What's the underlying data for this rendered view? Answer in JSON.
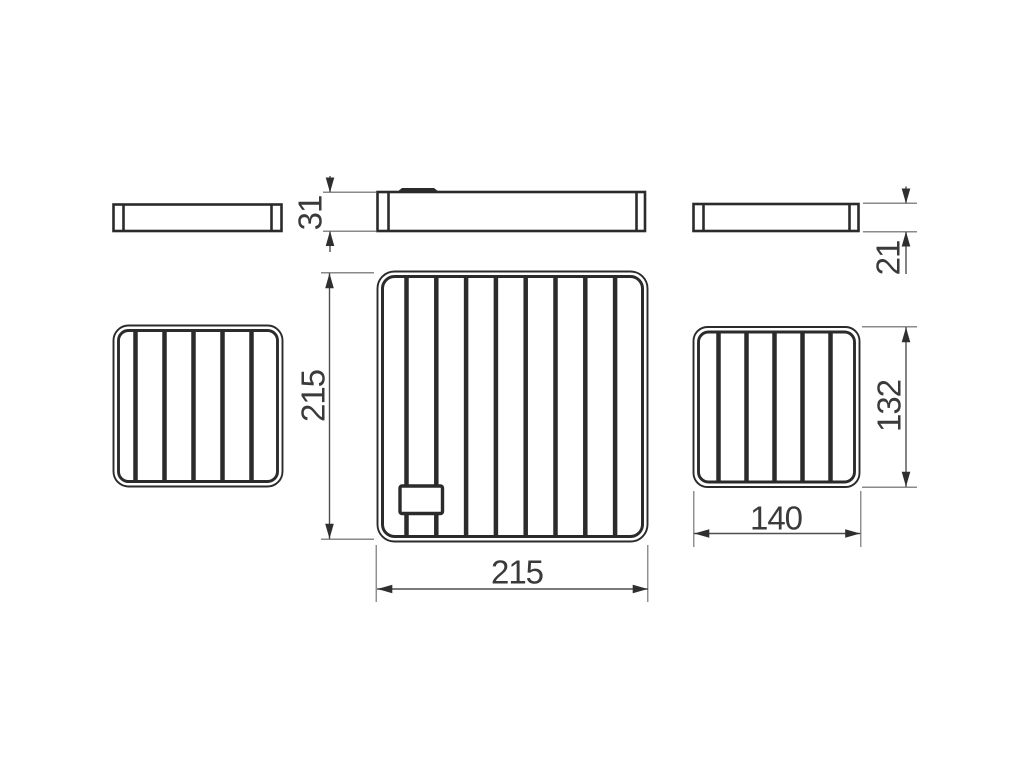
{
  "canvas": {
    "width": "1024",
    "height": "768",
    "background": "#ffffff"
  },
  "colors": {
    "part_line": "#2b2b2b",
    "dim_line": "#4f4f4f",
    "ext_line": "#8a8a8a",
    "arrow": "#2f2f2f",
    "label_text": "#3a3a3a"
  },
  "drawing": {
    "kind": "technical-dimension-drawing",
    "subject": "three rectangular wire grid shelves: side profile views (top row) and top plan views (bottom row)",
    "views": {
      "side_view_left_small": {
        "bars": "0",
        "note": "thin profile with end caps"
      },
      "side_view_center_large": {
        "bars": "0",
        "note": "thin profile with end caps and small top tab"
      },
      "side_view_right_small": {
        "bars": "0",
        "note": "thin profile with end caps"
      },
      "plan_view_left_small": {
        "bars": "5"
      },
      "plan_view_center_large": {
        "bars": "8",
        "note": "small rectangular bracket near bottom-left"
      },
      "plan_view_right_small": {
        "bars": "5"
      }
    }
  },
  "dims": {
    "large_shelf_height_mm": "31",
    "small_shelf_height_mm": "21",
    "large_shelf_depth_mm": "215",
    "large_shelf_width_mm": "215",
    "small_shelf_depth_mm": "132",
    "small_shelf_width_mm": "140"
  }
}
